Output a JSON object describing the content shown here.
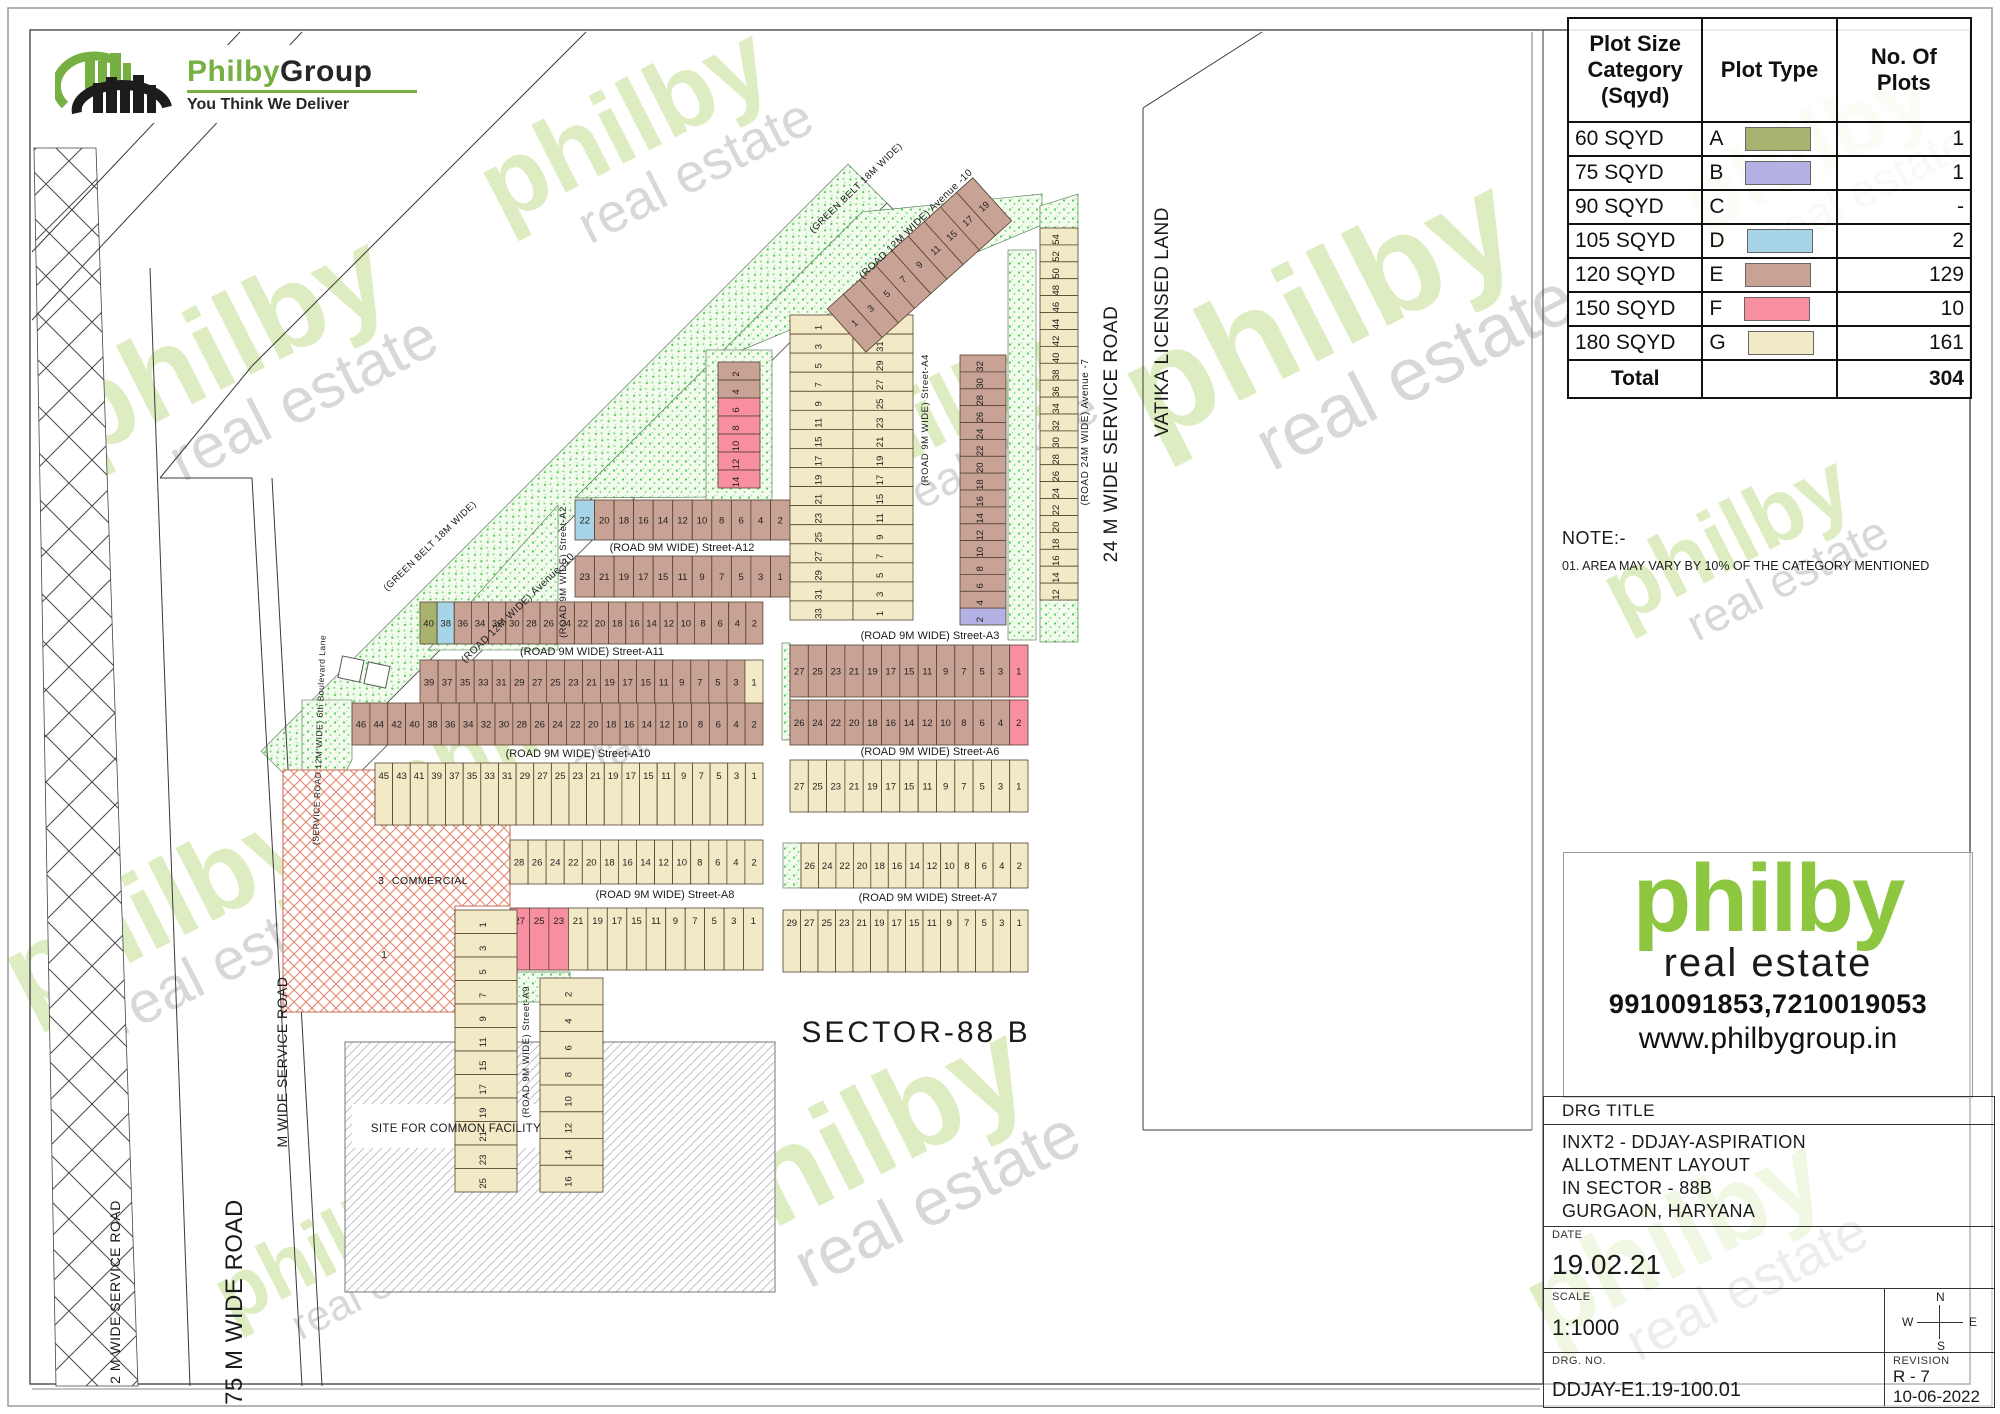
{
  "logo": {
    "brand1": "Philby",
    "brand2": "Group",
    "tagline": "You Think We Deliver"
  },
  "legend": {
    "headers": [
      "Plot Size Category (Sqyd)",
      "Plot Type",
      "No. Of Plots"
    ],
    "rows": [
      {
        "category": "60 SQYD",
        "type_letter": "A",
        "swatch": "#a9b36f",
        "count": "1"
      },
      {
        "category": "75 SQYD",
        "type_letter": "B",
        "swatch": "#b4b2e4",
        "count": "1"
      },
      {
        "category": "90 SQYD",
        "type_letter": "C",
        "swatch": "",
        "count": "-"
      },
      {
        "category": "105 SQYD",
        "type_letter": "D",
        "swatch": "#a7d4e6",
        "count": "2"
      },
      {
        "category": "120 SQYD",
        "type_letter": "E",
        "swatch": "#c8a294",
        "count": "129"
      },
      {
        "category": "150 SQYD",
        "type_letter": "F",
        "swatch": "#f88fa0",
        "count": "10"
      },
      {
        "category": "180 SQYD",
        "type_letter": "G",
        "swatch": "#f2e9c6",
        "count": "161"
      }
    ],
    "total_label": "Total",
    "total_count": "304"
  },
  "note": {
    "title": "NOTE:-",
    "item": "01.  AREA MAY VARY BY 10% OF THE CATEGORY MENTIONED"
  },
  "brand": {
    "name": "philby",
    "sub": "real estate",
    "phone": "9910091853,7210019053",
    "website": "www.philbygroup.in"
  },
  "title_block": {
    "drg_title_label": "DRG TITLE",
    "title_lines": [
      "INXT2 - DDJAY-ASPIRATION",
      "ALLOTMENT LAYOUT",
      "IN SECTOR - 88B",
      "GURGAON, HARYANA"
    ],
    "date_label": "DATE",
    "date": "19.02.21",
    "scale_label": "SCALE",
    "scale": "1:1000",
    "drg_no_label": "DRG. NO.",
    "drg_no": "DDJAY-E1.19-100.01",
    "revision_label": "REVISION",
    "revision": "R - 7",
    "revision_date": "10-06-2022",
    "compass": {
      "n": "N",
      "s": "S",
      "e": "E",
      "w": "W"
    }
  },
  "plan": {
    "palette": {
      "A": "#a9b36f",
      "B": "#b4b2e4",
      "D": "#a7d4e6",
      "E": "#c8a294",
      "F": "#f88fa0",
      "G": "#f2e9c6"
    },
    "plot_border": "#54432f",
    "rows": [
      {
        "x": 575,
        "y": 500,
        "w": 215,
        "h": 40,
        "t": "E",
        "seq": "22:D 20 18 16 14 12 10 8 6 4 2"
      },
      {
        "x": 575,
        "y": 556,
        "w": 215,
        "h": 41,
        "t": "E",
        "seq": "23 21 19 17 15 11 9 7 5 3 1"
      },
      {
        "x": 420,
        "y": 602,
        "w": 343,
        "h": 42,
        "t": "E",
        "seq": "40:A 38:D 36 34 32 30 28 26 24 22 20 18 16 14 12 10 8 6 4 2"
      },
      {
        "x": 420,
        "y": 660,
        "w": 343,
        "h": 44,
        "t": "E",
        "seq": "39 37 35 33 31 29 27 25 23 21 19 17 15 11 9 7 5 3 1:G"
      },
      {
        "x": 352,
        "y": 703,
        "w": 411,
        "h": 42,
        "t": "E",
        "seq": "46 44 42 40 38 36 34 32 30 28 26 24 22 20 18 16 14 12 10 8 6 4 2"
      },
      {
        "x": 375,
        "y": 763,
        "w": 388,
        "h": 62,
        "t": "G",
        "seq": "45 43 41 39 37 35 33 31 29 27 25 23 21 19 17 15 11 9 7 5 3 1"
      },
      {
        "x": 510,
        "y": 840,
        "w": 253,
        "h": 44,
        "t": "G",
        "seq": "28 26 24 22 20 18 16 14 12 10 8 6 4 2"
      },
      {
        "x": 510,
        "y": 908,
        "w": 253,
        "h": 62,
        "t": "G",
        "seq": "27:F 25:F 23:F 21 19 17 15 11 9 7 5 3 1"
      },
      {
        "x": 790,
        "y": 645,
        "w": 238,
        "h": 52,
        "t": "E",
        "seq": "27 25 23 21 19 17 15 11 9 7 5 3 1:F"
      },
      {
        "x": 790,
        "y": 700,
        "w": 238,
        "h": 45,
        "t": "E",
        "seq": "26 24 22 20 18 16 14 12 10 8 6 4 2:F"
      },
      {
        "x": 790,
        "y": 760,
        "w": 238,
        "h": 52,
        "t": "G",
        "seq": "27 25 23 21 19 17 15 11 9 7 5 3 1"
      },
      {
        "x": 801,
        "y": 843,
        "w": 227,
        "h": 45,
        "t": "G",
        "seq": "26 24 22 20 18 16 14 12 10 8 6 4 2"
      },
      {
        "x": 783,
        "y": 910,
        "w": 245,
        "h": 62,
        "t": "G",
        "seq": "29 27 25 23 21 19 17 15 11 9 7 5 3 1"
      }
    ],
    "cols": [
      {
        "x": 455,
        "y": 910,
        "w": 62,
        "h": 282,
        "t": "G",
        "seq": "1 3 5 7 9 11 15 17 19 21 23 25"
      },
      {
        "x": 540,
        "y": 978,
        "w": 63,
        "h": 214,
        "t": "G",
        "seq": "2 4 6 8 10 12 14 16"
      },
      {
        "x": 790,
        "y": 315,
        "w": 63,
        "h": 305,
        "t": "G",
        "seq": "1 3 5 7 9 11 15 17 19 21 23 25 27 29 31 33"
      },
      {
        "x": 853,
        "y": 315,
        "w": 60,
        "h": 305,
        "t": "G",
        "seq": "33 31 29 27 25 23 21 19 17 15 11 9 7 5 3 1"
      },
      {
        "x": 960,
        "y": 355,
        "w": 46,
        "h": 270,
        "t": "E",
        "seq": "32 30 28 26 24 22 20 18 16 14 12 10 8 6 4 2:B"
      },
      {
        "x": 1040,
        "y": 228,
        "w": 38,
        "h": 372,
        "t": "G",
        "seq": "54 52 50 48 46 44 42 40 38 36 34 32 30 28 26 24 22 20 18 16 14 12"
      },
      {
        "x": 718,
        "y": 362,
        "w": 42,
        "h": 126,
        "t": "F",
        "seq": "2:E 4:E 6 8 10 12 14"
      }
    ],
    "diag_strip": {
      "x": 866,
      "y": 352,
      "angle": -42,
      "len": 196,
      "h": 58,
      "t": "E",
      "seq": "1 3 5 7 9 11 15 17 19"
    },
    "street_labels": [
      {
        "text": "(ROAD 9M WIDE) Street-A12",
        "x": 682,
        "y": 551
      },
      {
        "text": "(ROAD 9M WIDE) Street-A11",
        "x": 592,
        "y": 655
      },
      {
        "text": "(ROAD 9M WIDE) Street-A10",
        "x": 578,
        "y": 757
      },
      {
        "text": "(ROAD 9M WIDE) Street-A8",
        "x": 665,
        "y": 898
      },
      {
        "text": "(ROAD 9M WIDE) Street-A3",
        "x": 930,
        "y": 639
      },
      {
        "text": "(ROAD 9M WIDE) Street-A6",
        "x": 930,
        "y": 755
      },
      {
        "text": "(ROAD 9M WIDE) Street-A7",
        "x": 928,
        "y": 901
      }
    ],
    "rotated_labels": [
      {
        "text": "(ROAD 9M WIDE) Street-A2",
        "x": 566,
        "y": 572,
        "rot": -90,
        "size": 9.5
      },
      {
        "text": "(ROAD 9M WIDE) Street-A4",
        "x": 928,
        "y": 420,
        "rot": -90,
        "size": 9.5
      },
      {
        "text": "(ROAD 9M WIDE) Street-A9",
        "x": 529,
        "y": 1052,
        "rot": -90,
        "size": 9.5
      },
      {
        "text": "(ROAD 24M WIDE) Avenue -7",
        "x": 1088,
        "y": 432,
        "rot": -90,
        "size": 10
      },
      {
        "text": "(GREEN BELT 18M WIDE)",
        "x": 432,
        "y": 548,
        "rot": -44,
        "size": 9.5
      },
      {
        "text": "(GREEN BELT 18M WIDE)",
        "x": 858,
        "y": 190,
        "rot": -44,
        "size": 9.5
      },
      {
        "text": "(ROAD 12M WIDE) Avenue -10",
        "x": 520,
        "y": 610,
        "rot": -44,
        "size": 10
      },
      {
        "text": "(ROAD 12M WIDE) Avenue -10",
        "x": 918,
        "y": 226,
        "rot": -44,
        "size": 10
      },
      {
        "text": "(SERVICE ROAD 12M WIDE) 6th Boulevard Lane",
        "x": 322,
        "y": 740,
        "rot": -88,
        "size": 8.5
      },
      {
        "text": "24 M WIDE SERVICE ROAD",
        "x": 1117,
        "y": 434,
        "rot": -90,
        "size": 19
      },
      {
        "text": "VATIKA LICENSED LAND",
        "x": 1168,
        "y": 322,
        "rot": -90,
        "size": 19
      },
      {
        "text": "75 M WIDE ROAD",
        "x": 242,
        "y": 1302,
        "rot": -90,
        "size": 24
      },
      {
        "text": "2 M WIDE SERVICE ROAD",
        "x": 120,
        "y": 1292,
        "rot": -90,
        "size": 14
      },
      {
        "text": "M WIDE SERVICE ROAD",
        "x": 287,
        "y": 1062,
        "rot": -90,
        "size": 14
      }
    ],
    "area_labels": [
      {
        "text": "SECTOR-88 B",
        "x": 916,
        "y": 1042,
        "size": 30,
        "ls": 3
      },
      {
        "text": "COMMERCIAL",
        "x": 430,
        "y": 884,
        "size": 10.5,
        "ls": 0.5
      },
      {
        "text": "3",
        "x": 381,
        "y": 884,
        "size": 10.5,
        "ls": 0
      },
      {
        "text": "1",
        "x": 384,
        "y": 958,
        "size": 10.5,
        "ls": 0
      },
      {
        "text": "SITE FOR COMMON FACILITY",
        "x": 456,
        "y": 1132,
        "size": 11.5,
        "ls": 0.3
      }
    ],
    "watermark": {
      "line1": "philby",
      "line2": "real estate",
      "color1": "#bcdd85",
      "color2": "#a9a9a9",
      "spots": [
        [
          240,
          380,
          0.8
        ],
        [
          640,
          155,
          0.7
        ],
        [
          175,
          940,
          0.75
        ],
        [
          520,
          760,
          0.6
        ],
        [
          950,
          440,
          0.6
        ],
        [
          1340,
          350,
          0.95
        ],
        [
          870,
          1180,
          0.85
        ],
        [
          340,
          1270,
          0.55
        ],
        [
          1690,
          1270,
          0.72
        ],
        [
          1820,
          175,
          0.6
        ],
        [
          1740,
          565,
          0.6
        ]
      ]
    }
  }
}
